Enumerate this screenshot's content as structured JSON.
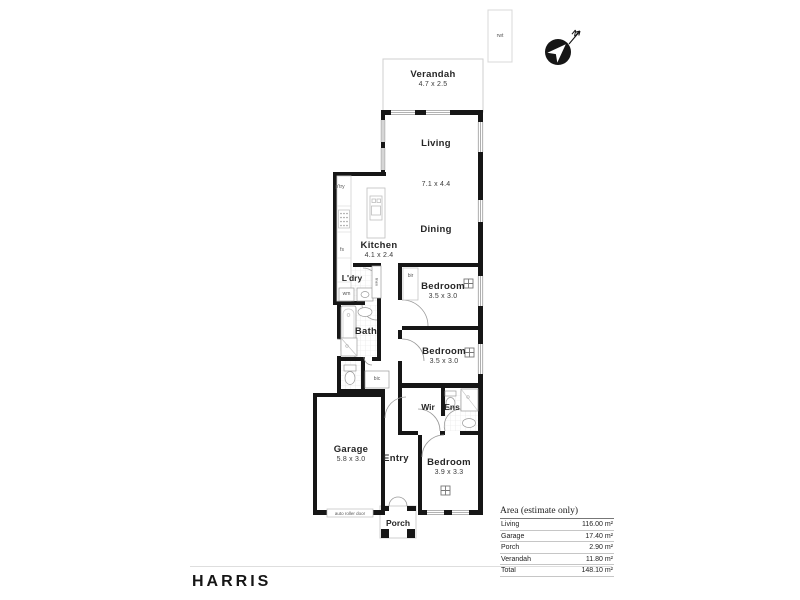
{
  "brand": {
    "logo_text": "HARRIS"
  },
  "compass": {
    "north_label": "N"
  },
  "site": {
    "rainwater_tank_label": "rwt"
  },
  "rooms": {
    "verandah": {
      "name": "Verandah",
      "dims": "4.7 x 2.5"
    },
    "living": {
      "name": "Living",
      "dims": "7.1 x 4.4"
    },
    "dining": {
      "name": "Dining"
    },
    "kitchen": {
      "name": "Kitchen",
      "dims": "4.1 x 2.4"
    },
    "laundry": {
      "name": "L'dry"
    },
    "bath": {
      "name": "Bath"
    },
    "bedroom1": {
      "name": "Bedroom",
      "dims": "3.5 x 3.0"
    },
    "bedroom2": {
      "name": "Bedroom",
      "dims": "3.5 x 3.0"
    },
    "bedroom3": {
      "name": "Bedroom",
      "dims": "3.9 x 3.3"
    },
    "wir": {
      "name": "Wir"
    },
    "ens": {
      "name": "Ens"
    },
    "entry": {
      "name": "Entry"
    },
    "garage": {
      "name": "Garage",
      "dims": "5.8 x 3.0"
    },
    "porch": {
      "name": "Porch"
    }
  },
  "fixtures": {
    "pantry_label": "p'try",
    "fridge_space_label": "fs",
    "washing_machine_label": "wm",
    "linen_label": "linen",
    "built_in_robe_label": "bir",
    "cupboard_label": "bic",
    "roller_door_label": "auto roller door"
  },
  "area_table": {
    "title": "Area (estimate only)",
    "rows": [
      {
        "label": "Living",
        "value": "116.00 m²"
      },
      {
        "label": "Garage",
        "value": "17.40 m²"
      },
      {
        "label": "Porch",
        "value": "2.90 m²"
      },
      {
        "label": "Verandah",
        "value": "11.80 m²"
      },
      {
        "label": "Total",
        "value": "148.10 m²"
      }
    ]
  },
  "colors": {
    "wall": "#161616",
    "brand_text": "#161616"
  }
}
